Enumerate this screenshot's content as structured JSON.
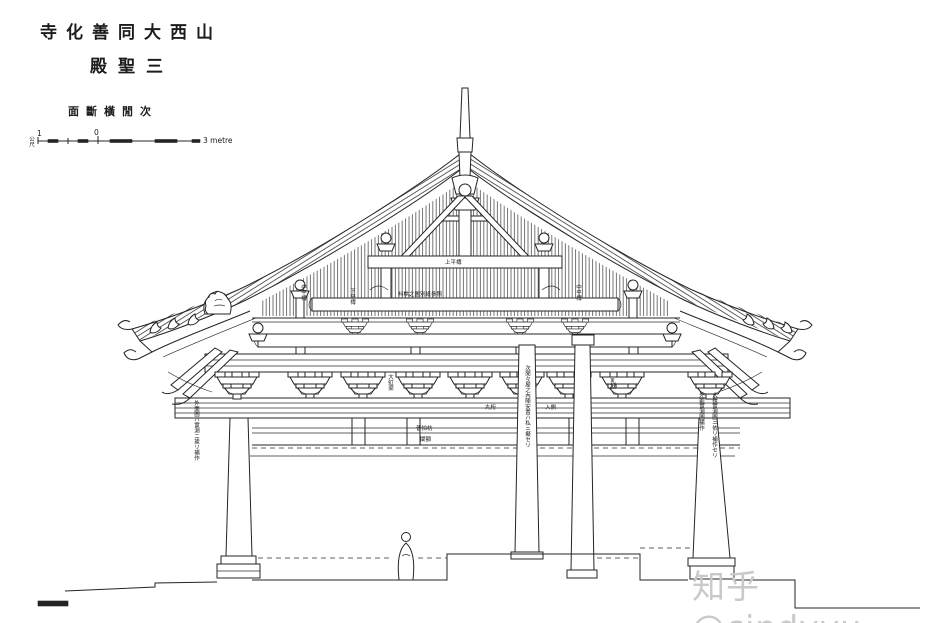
{
  "title": {
    "line1": "寺化善同大西山",
    "line2": "殿聖三",
    "subtitle": "面斷橫閒次"
  },
  "scale_bar": {
    "unit_label": "公尺",
    "tick_one": "1",
    "tick_zero": "0",
    "right_label": "3 metre"
  },
  "watermark": {
    "text": "知乎@cindyyu",
    "color": "#c9c9c9"
  },
  "drawing": {
    "subject": "次間橫斷面 (cross section) of 三聖殿, 善化寺, 大同, 山西",
    "ink_color": "#242424",
    "paper_color": "#ffffff",
    "annotations": [
      "上平槫",
      "枓栱之圖別紙參照",
      "丸桁",
      "入側",
      "大虹梁",
      "乳栿",
      "普拍枋",
      "闌額",
      "外面圖ハ實測ニ據リ補作",
      "外觀實測圖補作",
      "大樣實測圖ニ依リ補作セリ",
      "次閒々屋之內陣安置ハ私ニ擬セリ",
      "中平槫",
      "下平槫",
      "中平槫"
    ]
  }
}
